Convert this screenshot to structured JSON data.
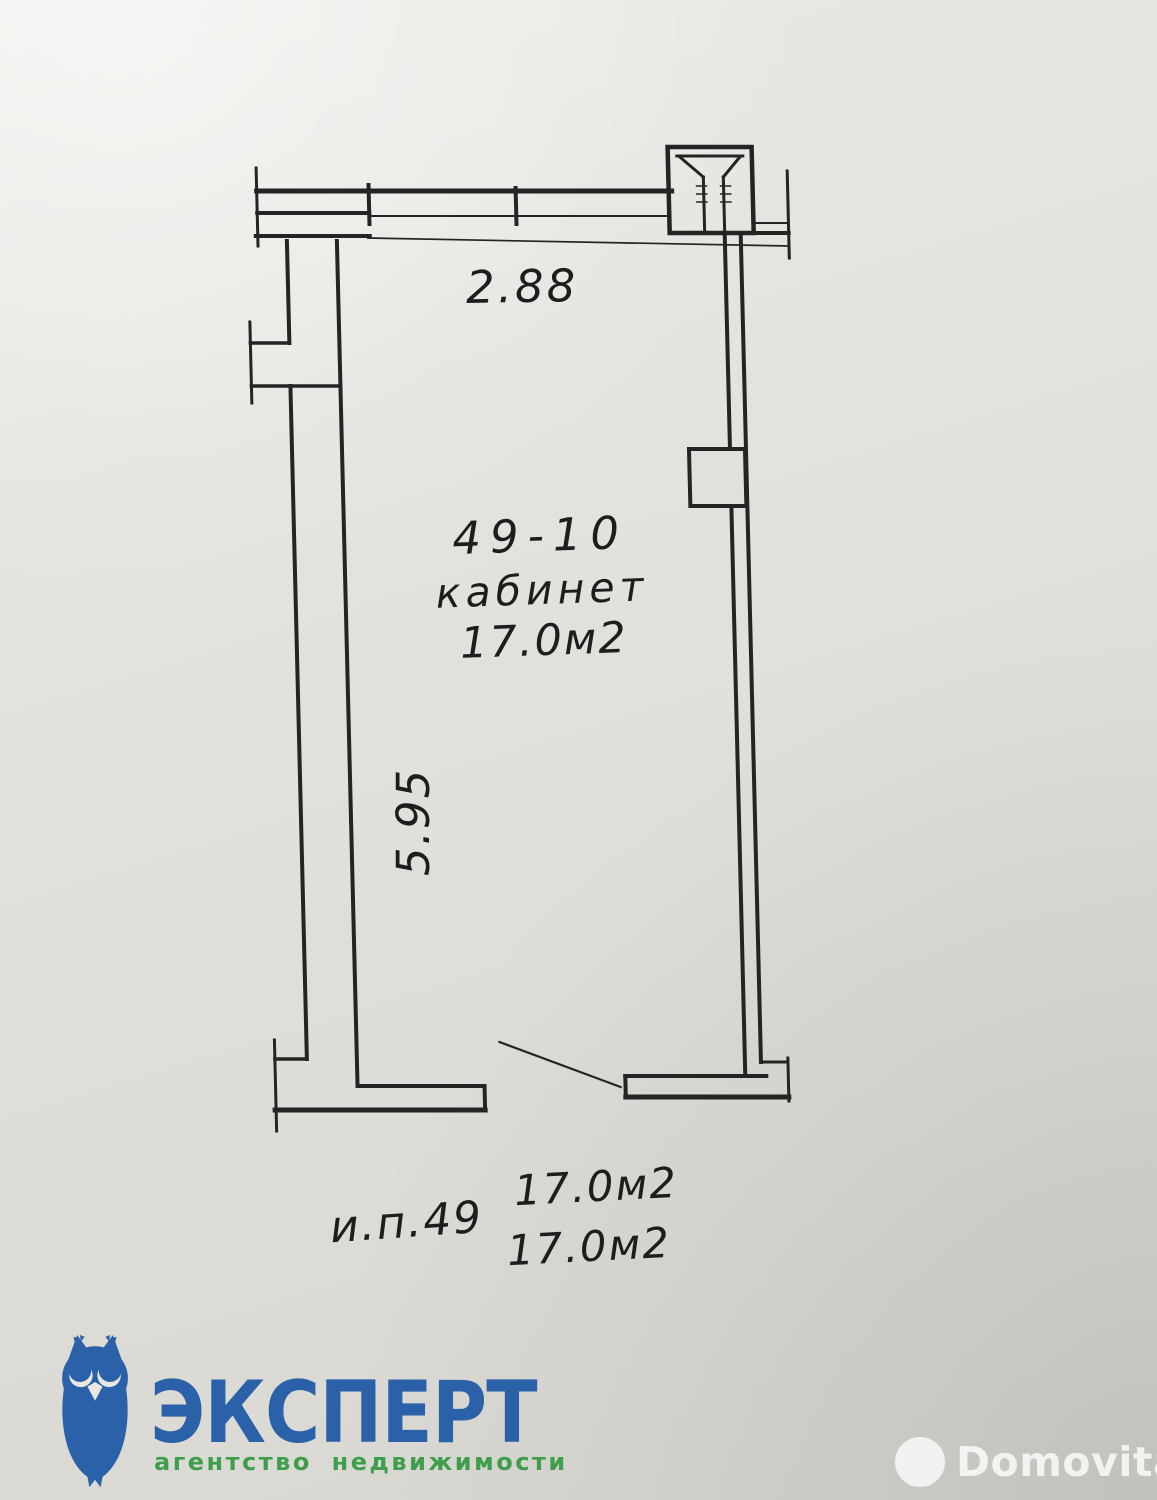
{
  "floor_plan": {
    "dimensions": {
      "top": "2.88",
      "left": "5.95"
    },
    "room": {
      "number": "49-10",
      "type": "кабинет",
      "area": "17.0м2"
    },
    "annotations": {
      "unit": "и.п.49",
      "area_line1": "17.0м2",
      "area_line2": "17.0м2"
    }
  },
  "branding": {
    "agency_name": "ЭКСПЕРТ",
    "agency_tagline": "агентство недвижимости",
    "watermark": "Domovita"
  },
  "colors": {
    "ink": "#242424",
    "paper": "#e2e0db",
    "agency_blue": "#2b61a8",
    "agency_green": "#3f9e4c",
    "watermark_white": "rgba(255,255,255,0.78)"
  }
}
